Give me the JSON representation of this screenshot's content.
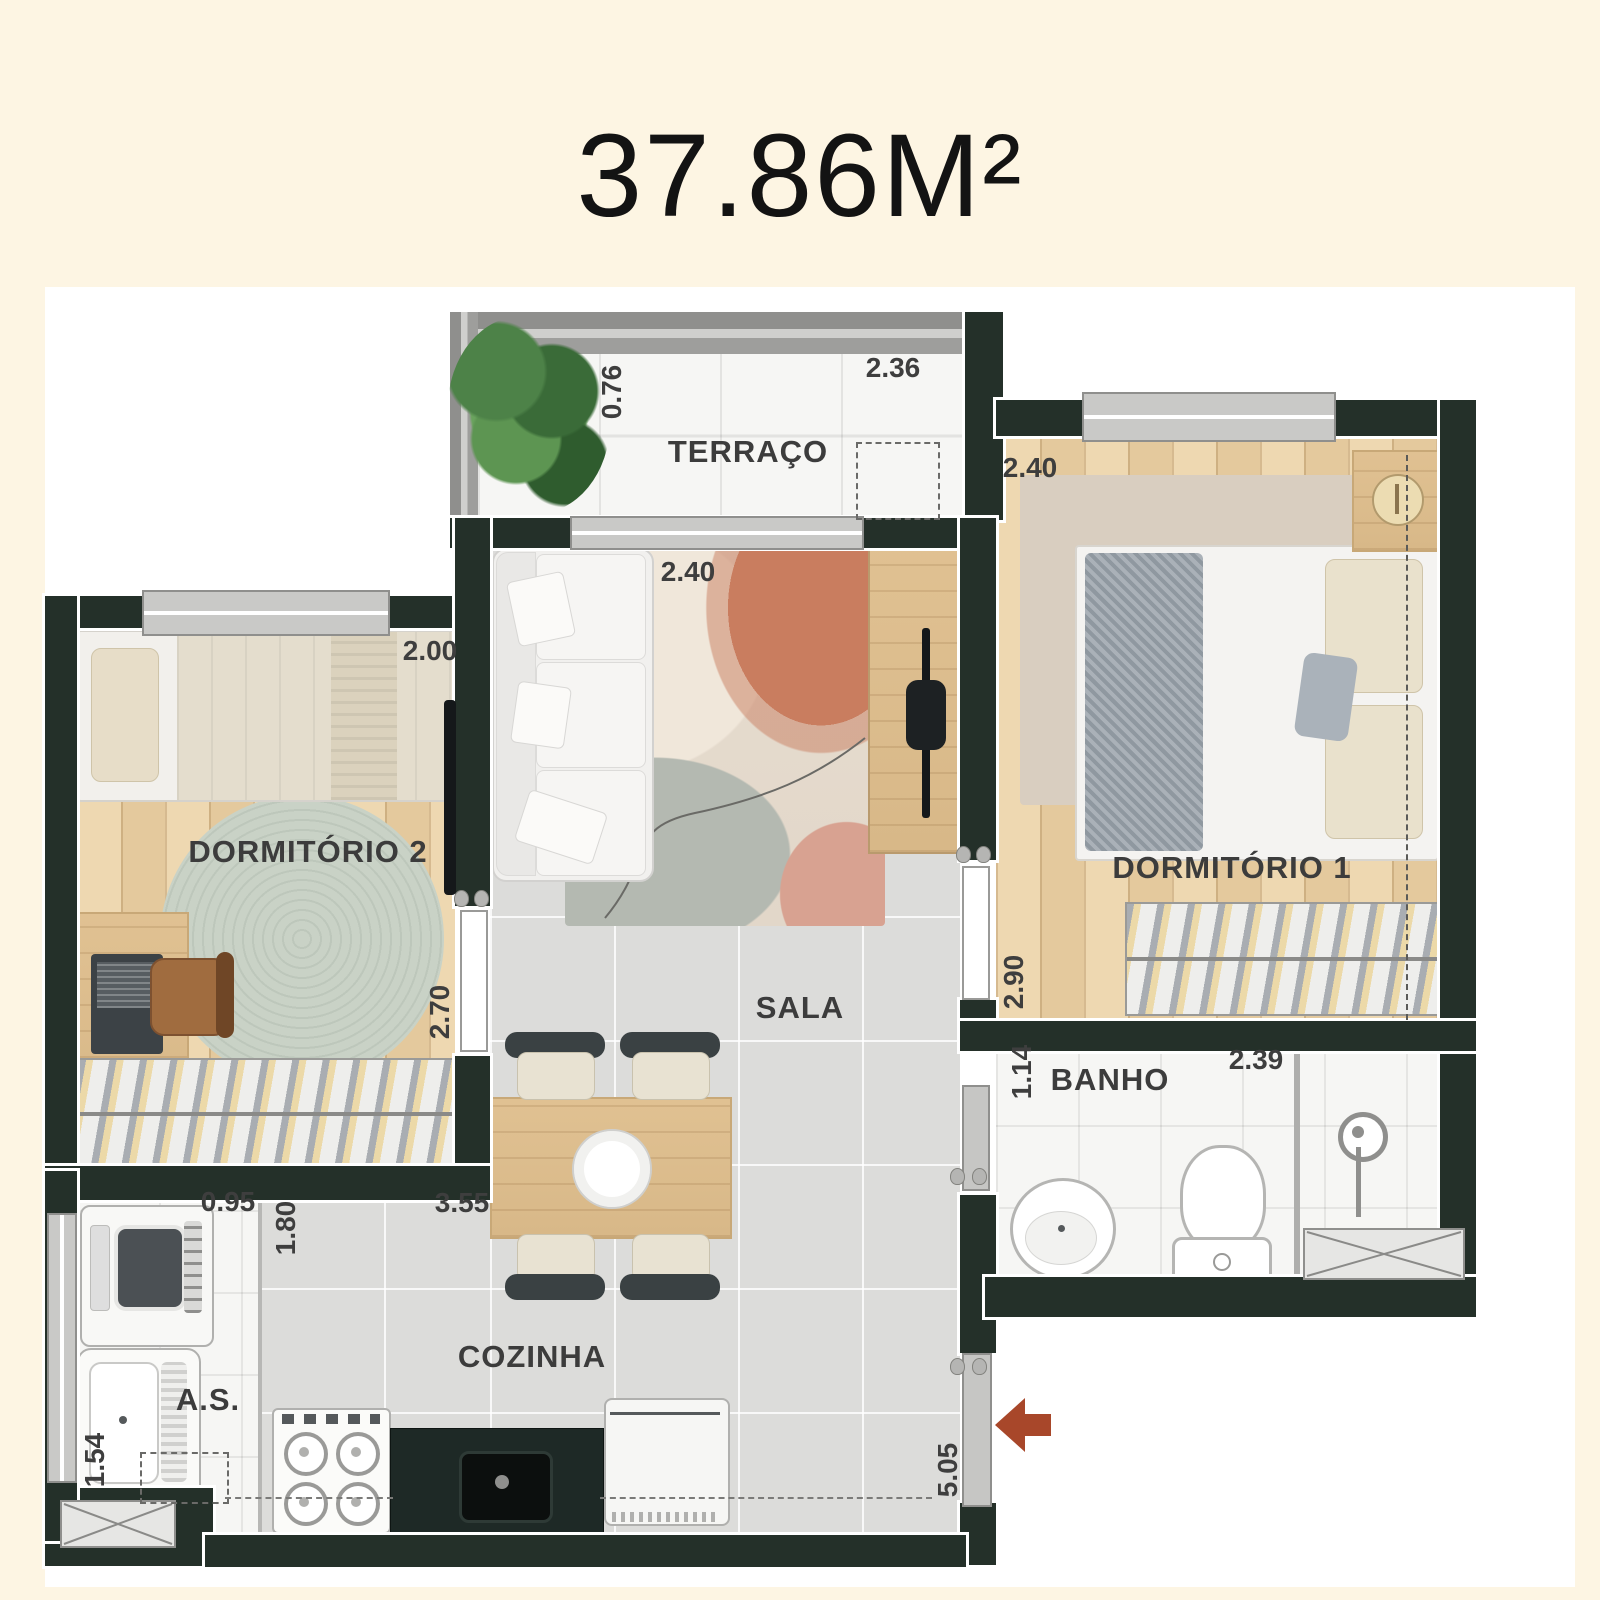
{
  "title": "37.86M²",
  "rooms": {
    "terraco": {
      "label": "TERRAÇO",
      "width": "2.36",
      "depth": "0.76"
    },
    "sala": {
      "label": "SALA",
      "width": "2.40"
    },
    "dormitorio1": {
      "label": "DORMITÓRIO 1",
      "width": "2.40",
      "depth": "2.90"
    },
    "dormitorio2": {
      "label": "DORMITÓRIO 2",
      "width": "2.00",
      "depth": "2.70"
    },
    "banho": {
      "label": "BANHO",
      "width": "2.39",
      "depth": "1.14"
    },
    "area_servico": {
      "label": "A.S.",
      "width": "0.95",
      "depth": "1.54"
    },
    "cozinha": {
      "label": "COZINHA",
      "width": "3.55",
      "depth": "1.80",
      "length": "5.05"
    }
  },
  "colors": {
    "background": "#fdf5e3",
    "wall": "#243029",
    "wood_floor": "#e9d2a9",
    "tile_gray": "#dcdcda",
    "tile_white": "#f6f6f4",
    "entry_arrow": "#a8472a",
    "rug_sage": "#c7d0c5",
    "rug_beige": "#d9cec0"
  }
}
